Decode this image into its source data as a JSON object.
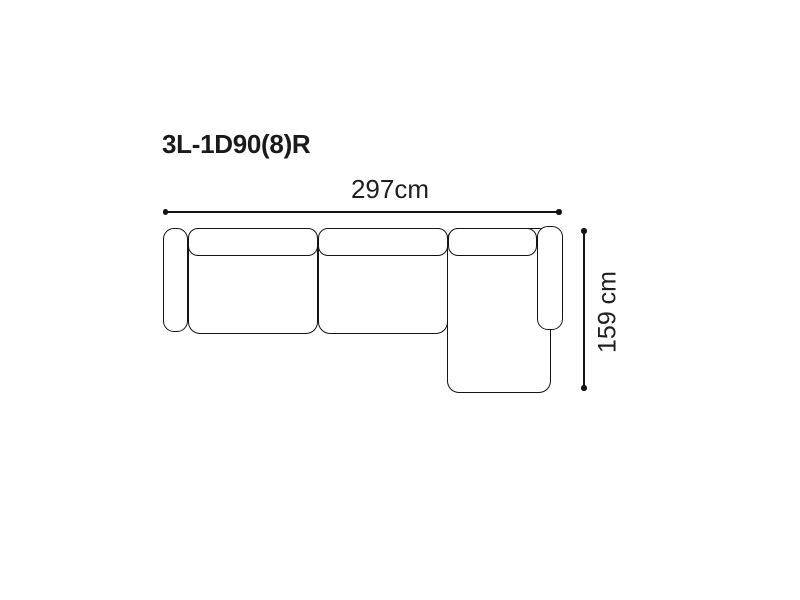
{
  "diagram": {
    "title": "3L-1D90(8)R",
    "width_dimension": {
      "label": "297cm"
    },
    "depth_dimension": {
      "label": "159 cm"
    },
    "colors": {
      "background": "#ffffff",
      "outline": "#141414",
      "title_text": "#1a1a1a",
      "dimension_text": "#1f1f1f"
    },
    "parts": [
      {
        "name": "left-armrest"
      },
      {
        "name": "seat-section-1"
      },
      {
        "name": "seat-section-2"
      },
      {
        "name": "chaise-section"
      },
      {
        "name": "backrest-cushion-1"
      },
      {
        "name": "backrest-cushion-2"
      },
      {
        "name": "backrest-cushion-3"
      },
      {
        "name": "right-armrest"
      }
    ]
  }
}
